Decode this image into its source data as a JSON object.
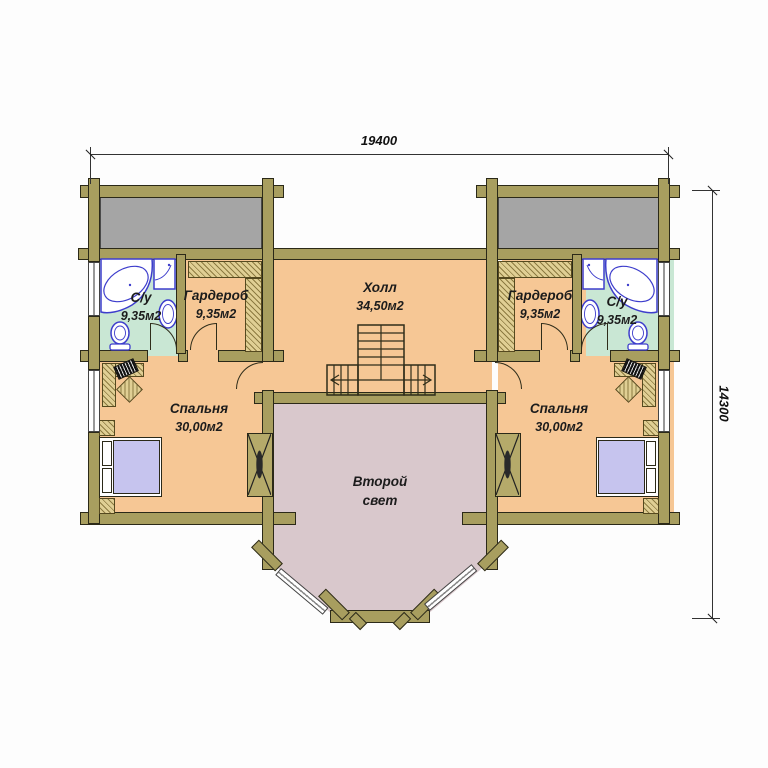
{
  "plan": {
    "title": "Второй этаж — план",
    "dimensions": {
      "width": "19400",
      "height": "14300"
    },
    "rooms": {
      "hall": {
        "name": "Холл",
        "area": "34,50м2"
      },
      "bathroom_left": {
        "name": "С/у",
        "area": "9,35м2"
      },
      "wardrobe_left": {
        "name": "Гардероб",
        "area": "9,35м2"
      },
      "bedroom_left": {
        "name": "Спальня",
        "area": "30,00м2"
      },
      "bathroom_right": {
        "name": "С/у",
        "area": "9,35м2"
      },
      "wardrobe_right": {
        "name": "Гардероб",
        "area": "9,35м2"
      },
      "bedroom_right": {
        "name": "Спальня",
        "area": "30,00м2"
      },
      "second_light": {
        "name": "Второй свет"
      }
    },
    "colors": {
      "wall": "#a89e5f",
      "floor_main": "#f6c795",
      "floor_bathroom": "#c9e7d4",
      "floor_second_light": "#d9c8cc",
      "roof_gray": "#a5a5a5",
      "fixture_outline": "#3d3dcc",
      "bed": "#c6c4ee"
    }
  }
}
